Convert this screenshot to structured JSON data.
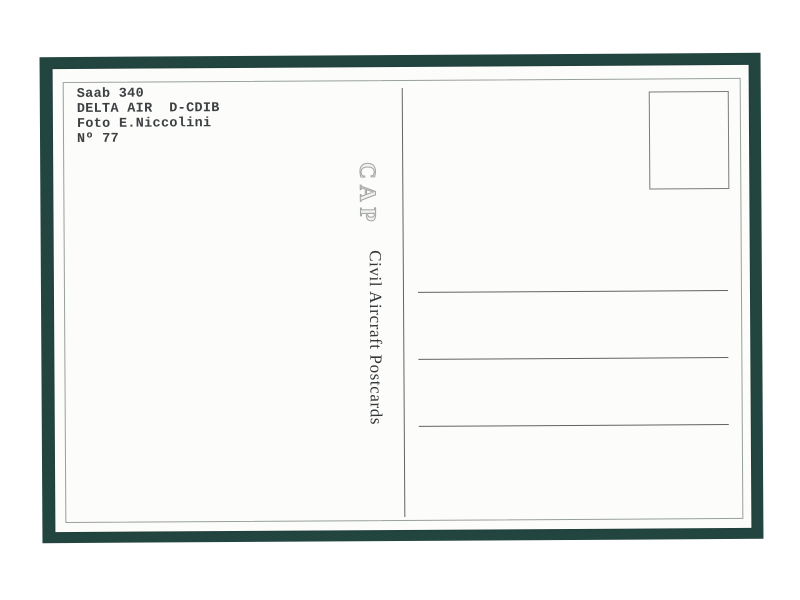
{
  "postcard": {
    "caption": {
      "lines": [
        "Saab 340",
        "DELTA AIR  D-CDIB",
        "Foto E.Niccolini",
        "Nº 77"
      ]
    },
    "publisher": {
      "logo_text": "CAP",
      "name": "Civil Aircraft Postcards"
    },
    "stamp_box": "empty",
    "address_rules_count": 3,
    "colors": {
      "mat_frame": "#234540",
      "card": "#fcfcfa",
      "inner_border": "#98a09b",
      "rule_line": "#5f6563",
      "caption_text": "#3d4042",
      "logo_outline": "#a3a7a2"
    }
  }
}
